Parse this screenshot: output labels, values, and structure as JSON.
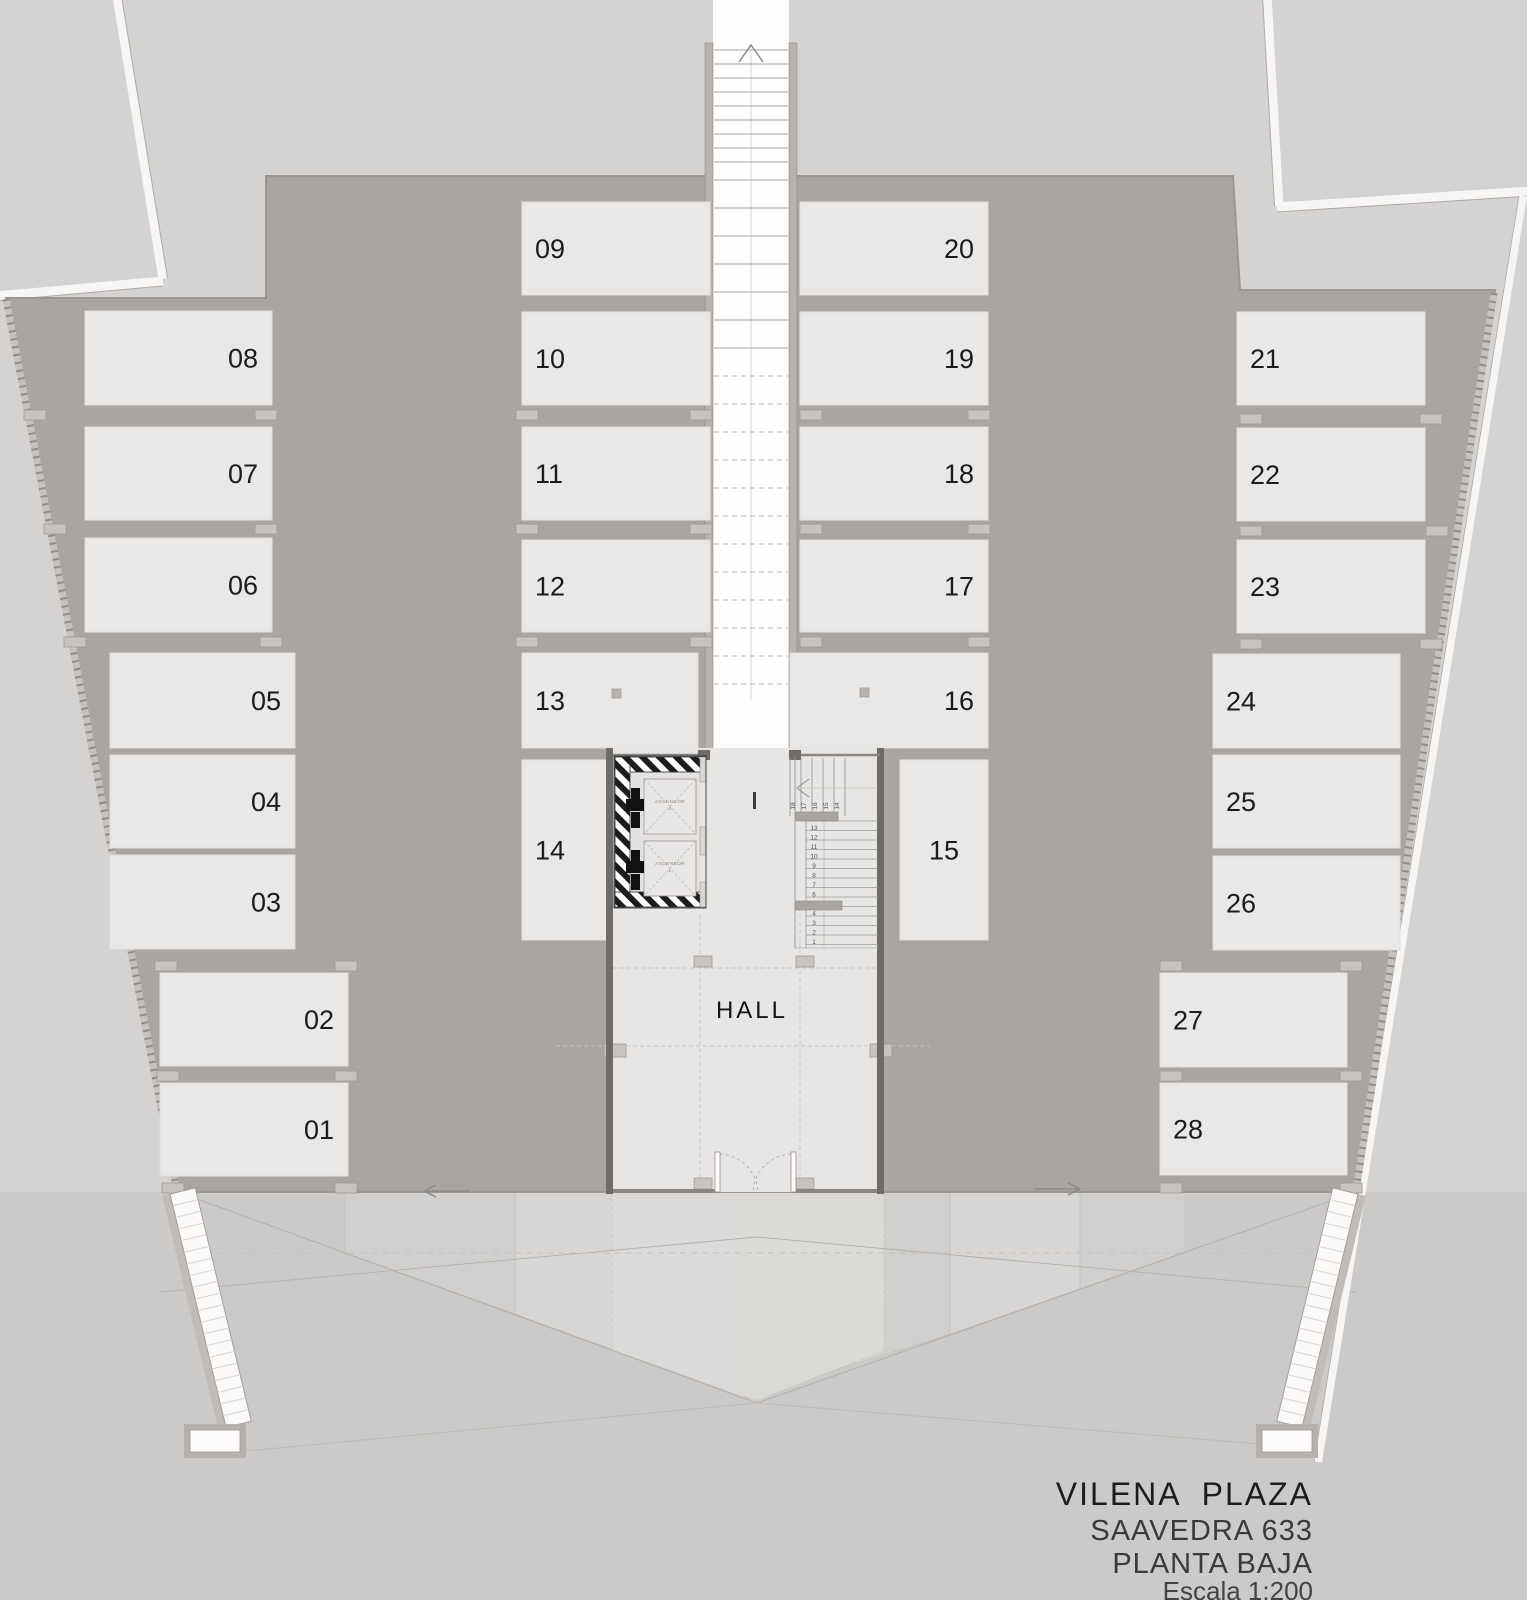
{
  "colors": {
    "background": "#d4d3d1",
    "floor": "#aba5a2",
    "parking_space": "#e9e8e6",
    "ramp_white": "#fefdfc",
    "text": "#1b1b1b"
  },
  "title_block": {
    "project": "VILENA  PLAZA",
    "address": "SAAVEDRA 633",
    "level": "PLANTA BAJA",
    "scale": "Escala 1:200"
  },
  "hall": {
    "label": "HALL"
  },
  "elevators": [
    {
      "name": "ASCENSOR",
      "number": "2"
    },
    {
      "name": "ASCENSOR",
      "number": "1"
    }
  ],
  "stairs": {
    "lower_steps": [
      "1",
      "2",
      "3",
      "4",
      "5",
      "6",
      "7",
      "8",
      "9",
      "10",
      "11",
      "12",
      "13"
    ],
    "upper_steps": [
      "14",
      "15",
      "16",
      "17",
      "18"
    ]
  },
  "parking_spaces": [
    {
      "label": "01",
      "x": 160,
      "y": 1083,
      "w": 188,
      "h": 93,
      "align": "right"
    },
    {
      "label": "02",
      "x": 160,
      "y": 973,
      "w": 188,
      "h": 93,
      "align": "right"
    },
    {
      "label": "03",
      "x": 110,
      "y": 855,
      "w": 185,
      "h": 94,
      "align": "right"
    },
    {
      "label": "04",
      "x": 110,
      "y": 755,
      "w": 185,
      "h": 93,
      "align": "right"
    },
    {
      "label": "05",
      "x": 110,
      "y": 653,
      "w": 185,
      "h": 95,
      "align": "right"
    },
    {
      "label": "06",
      "x": 85,
      "y": 538,
      "w": 187,
      "h": 94,
      "align": "right"
    },
    {
      "label": "07",
      "x": 85,
      "y": 427,
      "w": 187,
      "h": 93,
      "align": "right"
    },
    {
      "label": "08",
      "x": 85,
      "y": 311,
      "w": 187,
      "h": 94,
      "align": "right"
    },
    {
      "label": "09",
      "x": 522,
      "y": 202,
      "w": 188,
      "h": 93,
      "align": "left"
    },
    {
      "label": "10",
      "x": 522,
      "y": 312,
      "w": 188,
      "h": 93,
      "align": "left"
    },
    {
      "label": "11",
      "x": 522,
      "y": 427,
      "w": 188,
      "h": 93,
      "align": "left"
    },
    {
      "label": "12",
      "x": 522,
      "y": 540,
      "w": 188,
      "h": 92,
      "align": "left"
    },
    {
      "label": "13",
      "x": 522,
      "y": 653,
      "w": 176,
      "h": 95,
      "align": "left",
      "dot": true,
      "dot_x": 612,
      "dot_y": 689
    },
    {
      "label": "14",
      "x": 522,
      "y": 760,
      "w": 88,
      "h": 180,
      "align": "left"
    },
    {
      "label": "15",
      "x": 900,
      "y": 760,
      "w": 88,
      "h": 180,
      "align": "center"
    },
    {
      "label": "16",
      "x": 790,
      "y": 653,
      "w": 198,
      "h": 95,
      "align": "right",
      "dot": true,
      "dot_x": 860,
      "dot_y": 688
    },
    {
      "label": "17",
      "x": 800,
      "y": 540,
      "w": 188,
      "h": 92,
      "align": "right"
    },
    {
      "label": "18",
      "x": 800,
      "y": 427,
      "w": 188,
      "h": 93,
      "align": "right"
    },
    {
      "label": "19",
      "x": 800,
      "y": 312,
      "w": 188,
      "h": 93,
      "align": "right"
    },
    {
      "label": "20",
      "x": 800,
      "y": 202,
      "w": 188,
      "h": 93,
      "align": "right"
    },
    {
      "label": "21",
      "x": 1237,
      "y": 312,
      "w": 188,
      "h": 93,
      "align": "left"
    },
    {
      "label": "22",
      "x": 1237,
      "y": 428,
      "w": 188,
      "h": 93,
      "align": "left"
    },
    {
      "label": "23",
      "x": 1237,
      "y": 540,
      "w": 188,
      "h": 93,
      "align": "left"
    },
    {
      "label": "24",
      "x": 1213,
      "y": 654,
      "w": 187,
      "h": 94,
      "align": "left"
    },
    {
      "label": "25",
      "x": 1213,
      "y": 755,
      "w": 187,
      "h": 93,
      "align": "left"
    },
    {
      "label": "26",
      "x": 1213,
      "y": 856,
      "w": 187,
      "h": 94,
      "align": "left"
    },
    {
      "label": "27",
      "x": 1160,
      "y": 973,
      "w": 187,
      "h": 94,
      "align": "left"
    },
    {
      "label": "28",
      "x": 1160,
      "y": 1083,
      "w": 187,
      "h": 92,
      "align": "left"
    }
  ]
}
